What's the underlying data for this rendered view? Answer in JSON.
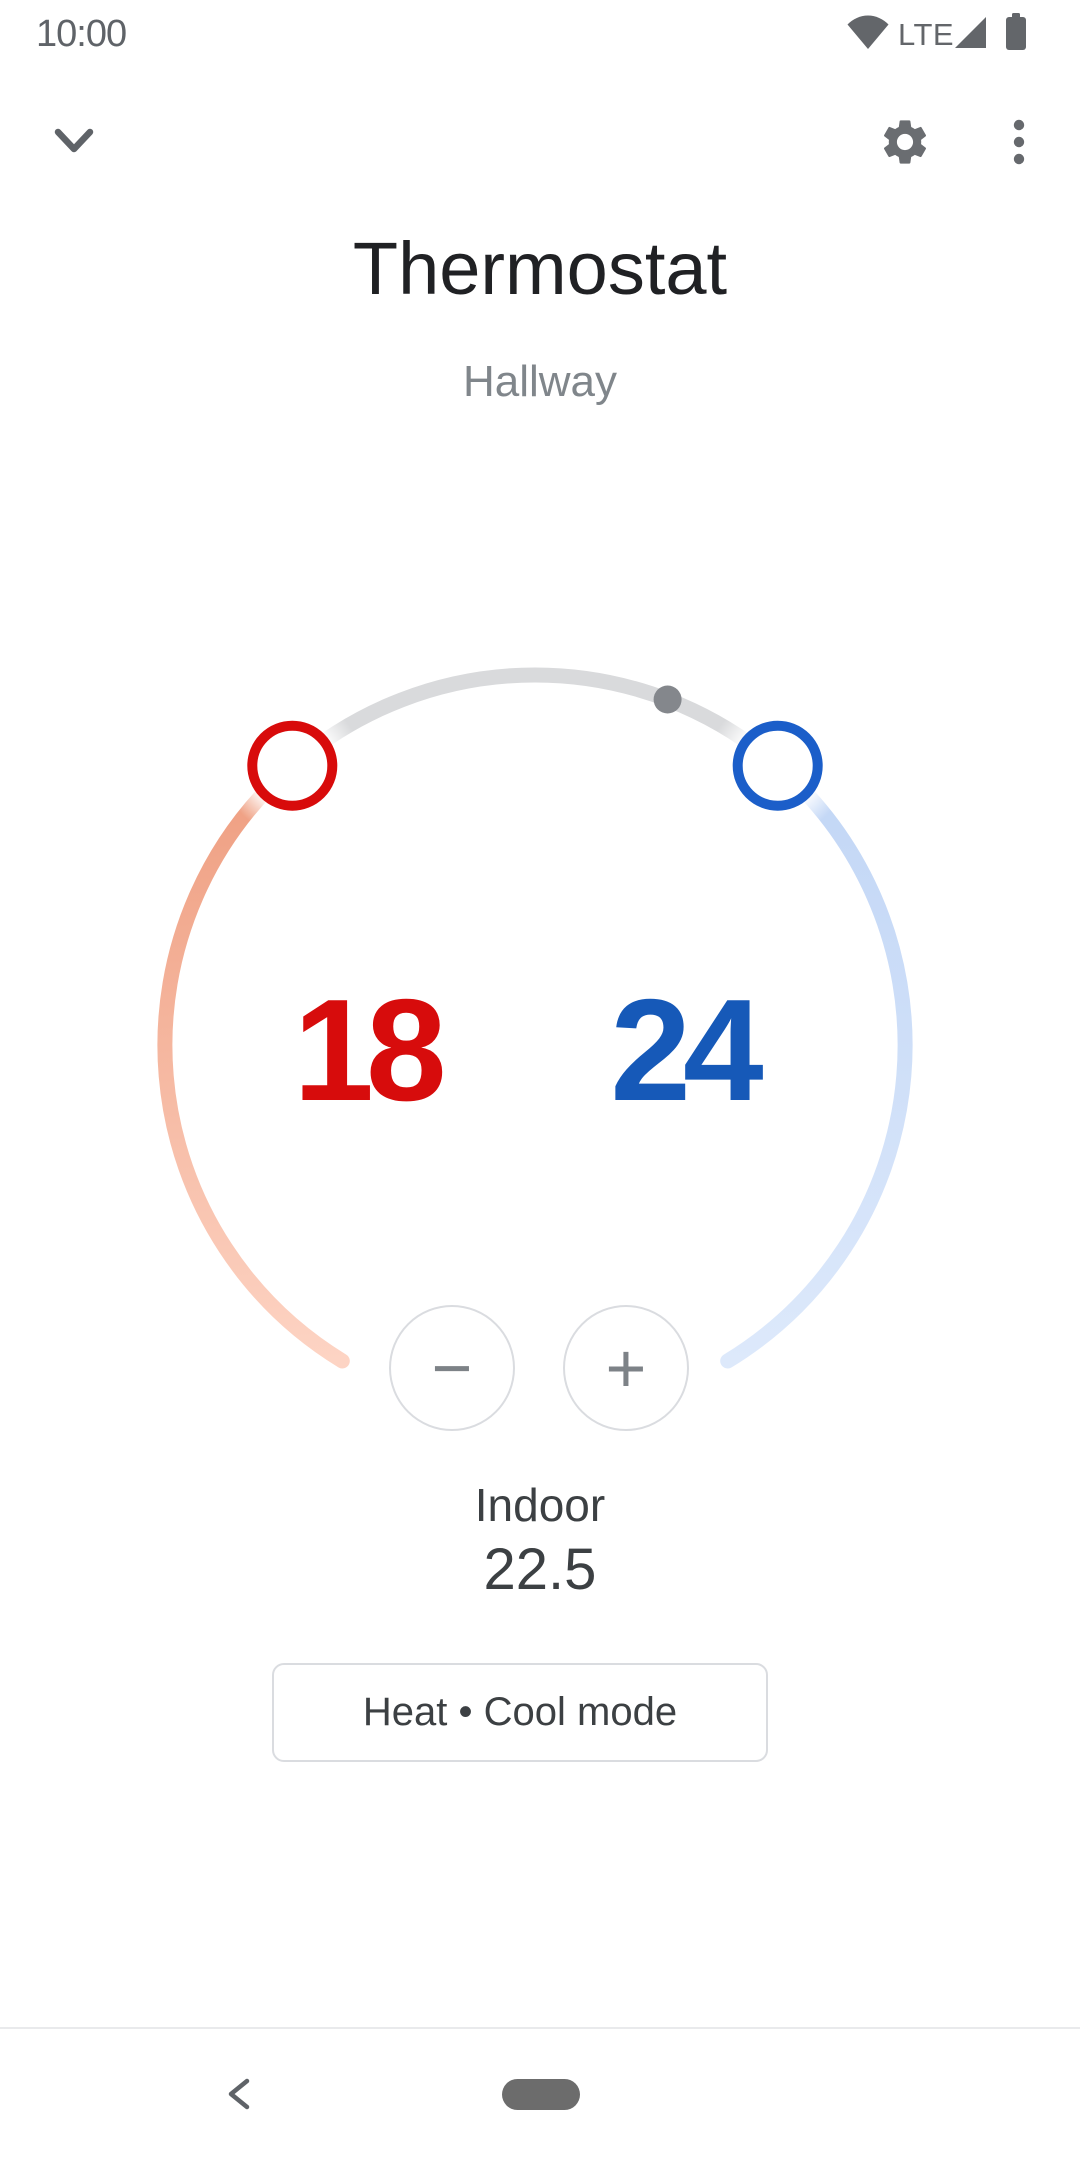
{
  "status_bar": {
    "time": "10:00",
    "network": "LTE"
  },
  "app_bar": {
    "collapse_icon": "chevron-down",
    "settings_icon": "gear",
    "overflow_icon": "three-dot-menu"
  },
  "header": {
    "title": "Thermostat",
    "subtitle": "Hallway"
  },
  "dial": {
    "heat_setpoint": "18",
    "cool_setpoint": "24",
    "ambient_marker": "current-temperature-dot"
  },
  "stepper": {
    "decrease": "−",
    "increase": "+"
  },
  "ambient": {
    "label": "Indoor",
    "value": "22.5"
  },
  "mode_button": {
    "label": "Heat • Cool mode"
  },
  "theme": {
    "heat_color": "#d70c0c",
    "cool_color": "#1659b8",
    "heat_handle_color": "#d80b0b",
    "cool_handle_color": "#1b5ec9",
    "heat_arc_start": "#efa083",
    "heat_arc_end": "#fdd4c4",
    "cool_arc_start": "#c3d7f6",
    "cool_arc_end": "#dde9fb",
    "track_color": "#d9dadc",
    "ambient_dot_color": "#84878c",
    "icon_gray": "#63666a",
    "outline_gray": "#dadce0"
  }
}
